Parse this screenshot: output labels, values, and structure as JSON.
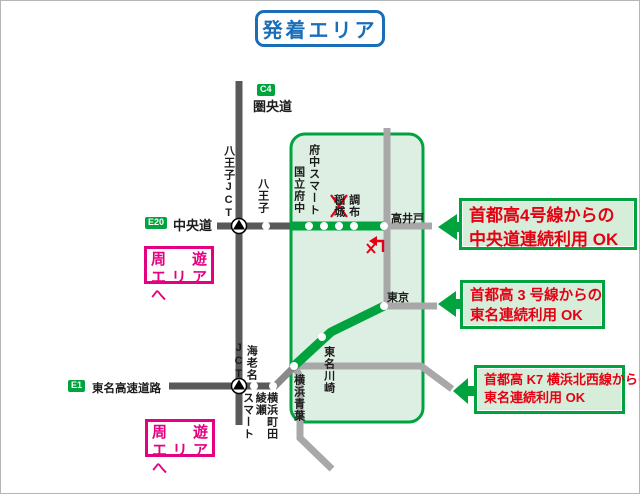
{
  "title": "発着エリア",
  "legend_roads": {
    "kenodo": {
      "badge": "C4",
      "name": "圏央道"
    },
    "chuodo": {
      "badge": "E20",
      "name": "中央道"
    },
    "tomei": {
      "badge": "E1",
      "name": "東名高速道路"
    }
  },
  "area": {
    "stations": {
      "hachioji_jct": "八王子JCT",
      "hachioji": "八王子",
      "kunitachi_fuchu": "国立府中",
      "fuchu_smart": "府中スマート",
      "inagi": "稲城",
      "chofu": "調布",
      "takaido": "高井戸",
      "tokyo": "東京",
      "tomei_kawasaki": "東名川崎",
      "yokohama_aoba": "横浜青葉",
      "ebina_jct_main": "海老名",
      "ebina_jct_suffix": "JCT",
      "ayase_smart_main": "綾瀬",
      "ayase_smart_suffix": "スマート",
      "yokohama_machida": "横浜町田"
    },
    "icons": {
      "inagi_closed": "red-x-cross",
      "chofu_no_transfer": "red-x-turn-arrow",
      "jct_marker": "black-triangle-in-circle",
      "ic_marker": "white-dot"
    }
  },
  "callouts": [
    {
      "line1": "首都高4号線からの",
      "line2": "中央道連続利用 OK"
    },
    {
      "line1": "首都高 3 号線からの",
      "line2": "東名連続利用 OK"
    },
    {
      "line1": "首都高 K7 横浜北西線からの",
      "line2": "東名連続利用 OK"
    }
  ],
  "tour_links": [
    {
      "line1": "周　遊",
      "line2": "エリアへ"
    },
    {
      "line1": "周　遊",
      "line2": "エリアへ"
    }
  ],
  "colors": {
    "green": "#00a33e",
    "area_fill": "#dcefe2",
    "callout_fill": "#d6edda",
    "red": "#e60012",
    "magenta": "#e50082",
    "blue": "#1a6eb8",
    "road_dark": "#595959",
    "road_light": "#a8a8a8"
  }
}
